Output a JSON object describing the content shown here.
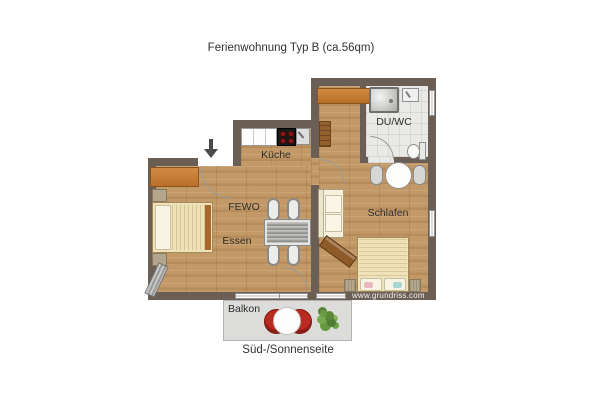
{
  "title": "Ferienwohnung Typ B (ca.56qm)",
  "rooms": {
    "kueche": "Küche",
    "fewo": "FEWO",
    "essen": "Essen",
    "schlafen": "Schlafen",
    "duwc": "DU/WC",
    "balkon": "Balkon"
  },
  "orientation_label": "Süd-/Sonnenseite",
  "watermark": "www.grundriss.com",
  "colors": {
    "wall": "#6b5e55",
    "floor_wood": "#c39a67",
    "floor_tile": "#e9e9e7",
    "furniture_orange": "#c07a30",
    "balcony_chair_red": "#b92a21",
    "balcony_floor": "#dcdcda"
  }
}
